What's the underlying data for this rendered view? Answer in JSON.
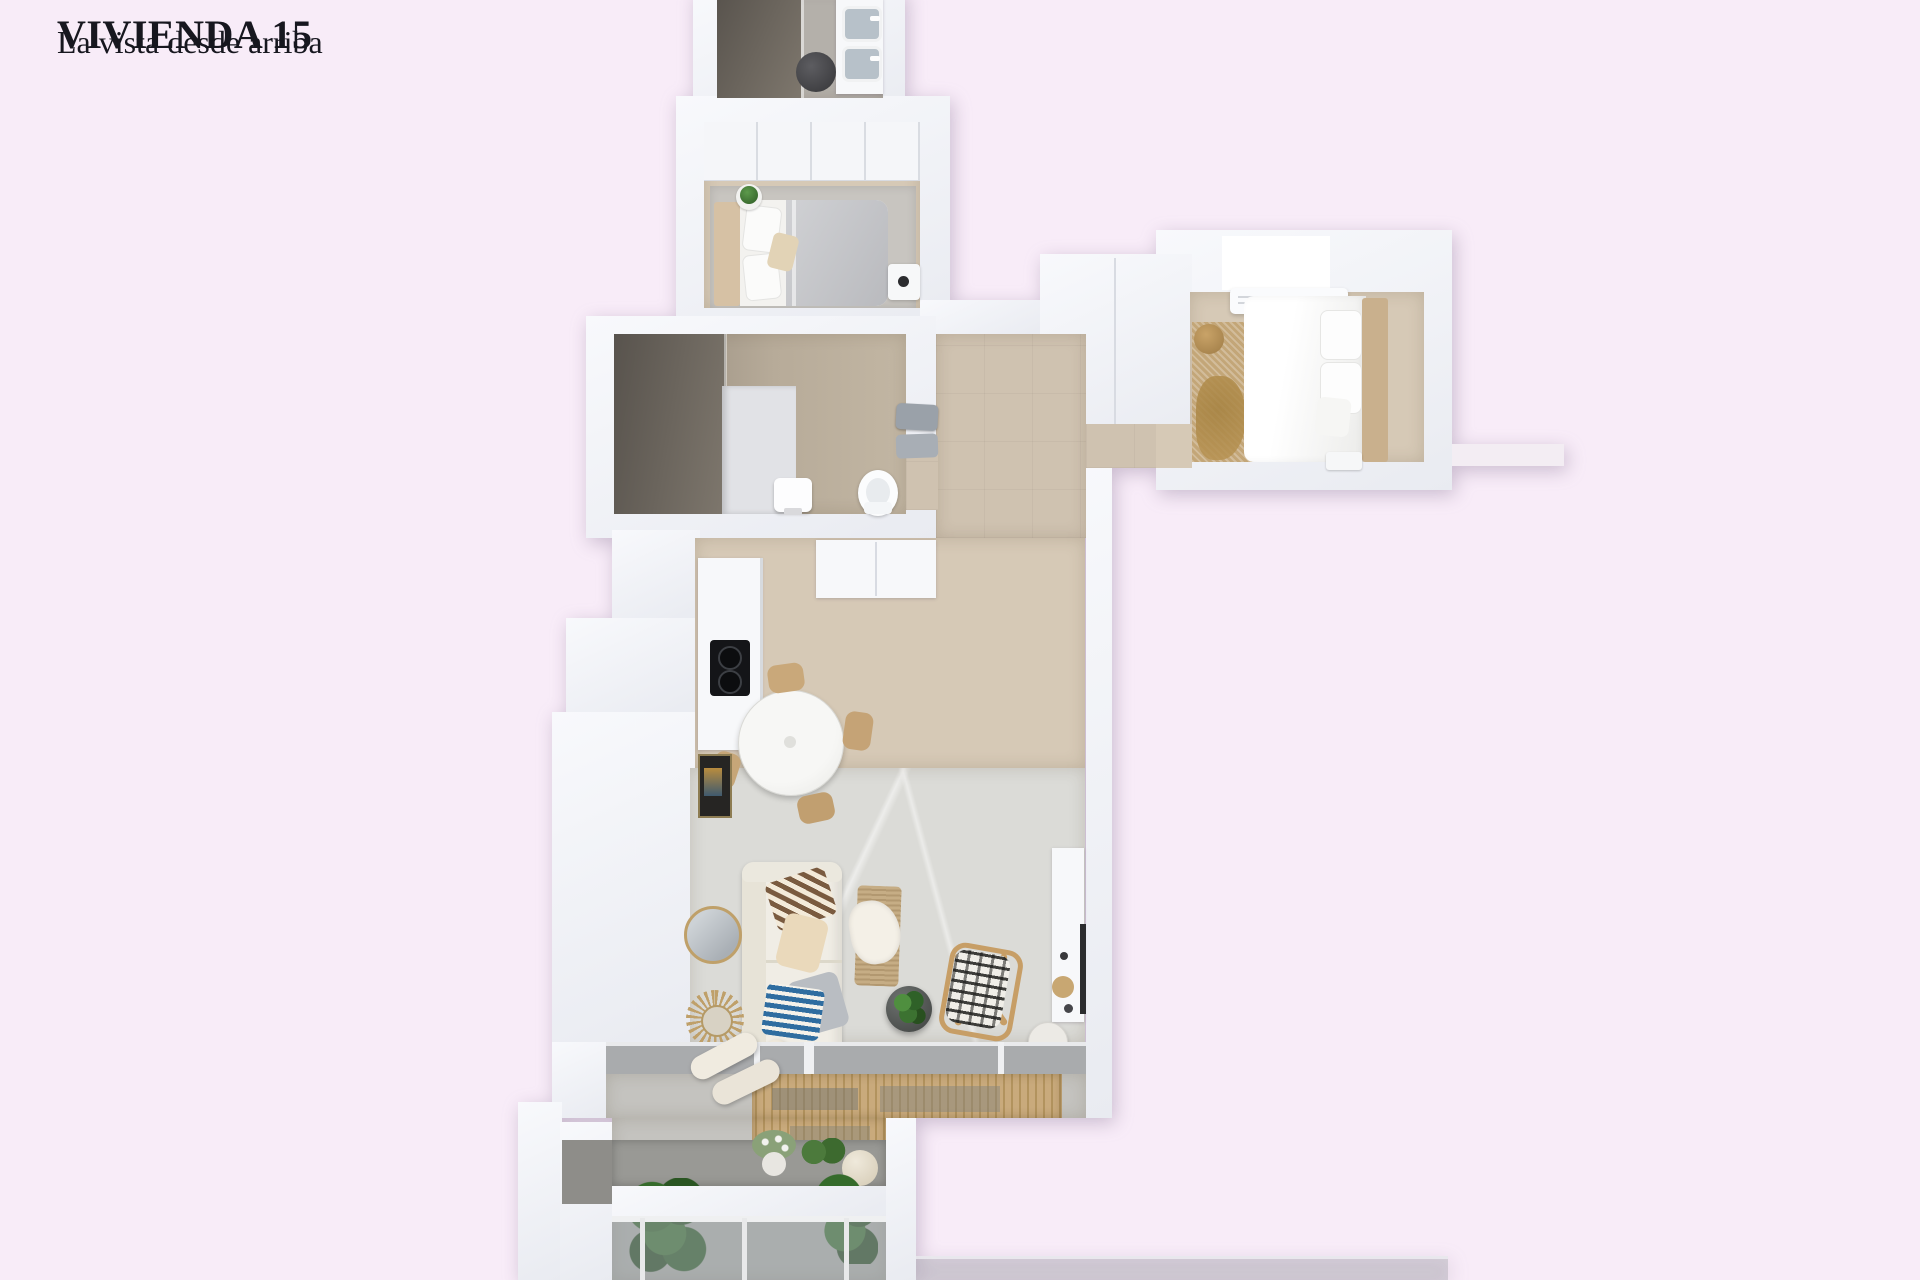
{
  "page": {
    "background": "#f8ecf8"
  },
  "header": {
    "title": "VIVIENDA 15",
    "subtitle": "La vista desde arriba",
    "text_color": "#17171f"
  },
  "palette": {
    "bg": "#f8ecf8",
    "ink": "#17171f",
    "wall_hi": "#f8f9fc",
    "wall_lo": "#e9ebf1",
    "wall_edge": "#d8dbe2",
    "floor_beige": "#d6c9b6",
    "floor_tile": "#cfc2b0",
    "floor_marble": "#dbdbd7",
    "taupe_a": "#8f8579",
    "taupe_b": "#c2b6a3",
    "shower_a": "#58534d",
    "shower_b": "#7e776d",
    "mat_a": "#c9aa7c",
    "mat_b": "#b2935e",
    "wood": "#c79e66",
    "gold": "#c3a678",
    "duvet_a": "#d0d1d4",
    "duvet_b": "#b9babe",
    "green": "#3c7231",
    "blue": "#2f6da0",
    "cream": "#efe9dc",
    "glass": "#a9abad"
  },
  "floorplan": {
    "view": "top-down 3D render",
    "rooms": [
      {
        "id": "bathroom-top",
        "features": [
          "walk-in-shower",
          "double-sink-vanity",
          "laundry-basket"
        ]
      },
      {
        "id": "bedroom-1",
        "features": [
          "wardrobe",
          "double-bed-gray-duvet",
          "rug",
          "nightstand",
          "plant"
        ]
      },
      {
        "id": "bedroom-2",
        "features": [
          "skylight",
          "ac-unit",
          "double-bed-white-duvet",
          "gold-rug",
          "pouf",
          "nightstand"
        ]
      },
      {
        "id": "bathroom-2",
        "features": [
          "dark-shower",
          "partition",
          "pedestal-sink",
          "toilet",
          "towels"
        ]
      },
      {
        "id": "hallway",
        "features": [
          "tile-floor",
          "closet-volume"
        ]
      },
      {
        "id": "kitchen",
        "features": [
          "counter",
          "cooktop",
          "tall-cabinets"
        ]
      },
      {
        "id": "dining",
        "features": [
          "round-table",
          "four-wood-chairs",
          "wall-art"
        ]
      },
      {
        "id": "living",
        "features": [
          "sofa",
          "patterned-cushions",
          "bolster",
          "round-mirror",
          "starburst-mirror",
          "jute-bench",
          "throw",
          "coffee-table-plant",
          "butterfly-chair",
          "tv-console",
          "side-table"
        ]
      },
      {
        "id": "terrace",
        "features": [
          "glazed-wall",
          "bamboo-mat",
          "bolster-cushions",
          "planter",
          "lavender-pot",
          "herbs",
          "pouf",
          "two-green-plants",
          "glass-railing"
        ]
      }
    ]
  }
}
